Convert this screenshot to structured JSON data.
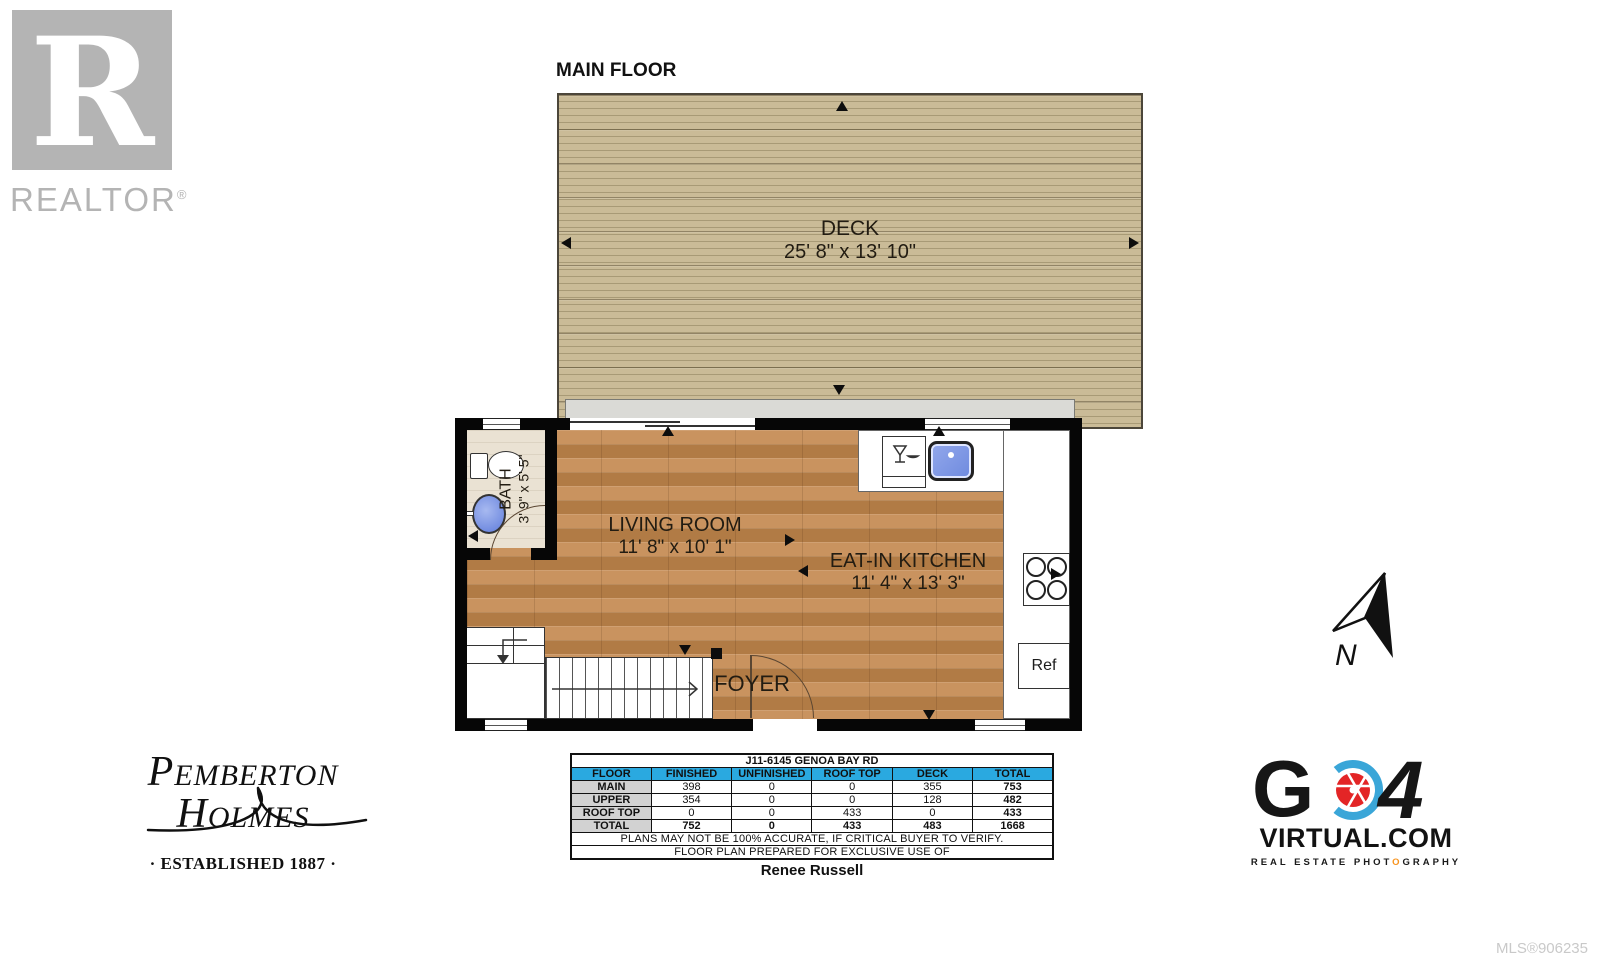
{
  "branding": {
    "realtor": {
      "letter": "R",
      "label": "REALTOR",
      "reg": "®"
    },
    "pemberton": {
      "cap1": "P",
      "rest1": "EMBERTON",
      "cap2": "H",
      "rest2": "OLMES",
      "established": "· ESTABLISHED 1887 ·"
    },
    "go4": {
      "g": "G",
      "four": "4",
      "virtual": "VIRTUAL.COM",
      "tagline_left": "REAL ESTATE PHOT",
      "tagline_o": "O",
      "tagline_right": "GRAPHY"
    },
    "mls": "MLS®906235"
  },
  "plan": {
    "title": "MAIN FLOOR",
    "north_letter": "N",
    "deck": {
      "name": "DECK",
      "dims": "25' 8\" x 13' 10\""
    },
    "living": {
      "name": "LIVING ROOM",
      "dims": "11' 8\" x 10' 1\""
    },
    "kitchen": {
      "name": "EAT-IN KITCHEN",
      "dims": "11' 4\" x 13' 3\""
    },
    "bath": {
      "name": "BATH",
      "dims": "3' 9\" x 5' 5\""
    },
    "foyer": {
      "name": "FOYER"
    },
    "fridge_label": "Ref"
  },
  "table": {
    "title": "J11-6145 GENOA BAY RD",
    "headers": [
      "FLOOR",
      "FINISHED",
      "UNFINISHED",
      "ROOF TOP",
      "DECK",
      "TOTAL"
    ],
    "rows": [
      {
        "cells": [
          "MAIN",
          "398",
          "0",
          "0",
          "355",
          "753"
        ]
      },
      {
        "cells": [
          "UPPER",
          "354",
          "0",
          "0",
          "128",
          "482"
        ]
      },
      {
        "cells": [
          "ROOF TOP",
          "0",
          "0",
          "433",
          "0",
          "433"
        ]
      },
      {
        "cells": [
          "TOTAL",
          "752",
          "0",
          "433",
          "483",
          "1668"
        ]
      }
    ],
    "disclaimer1": "PLANS MAY NOT BE 100% ACCURATE, IF CRITICAL BUYER TO VERIFY.",
    "disclaimer2": "FLOOR PLAN PREPARED FOR EXCLUSIVE USE OF",
    "prepared_for": "Renee Russell"
  },
  "colors": {
    "table_header_blue": "#2aa9e0",
    "wood_floor": "#c08955",
    "deck_wood": "#c3b491",
    "sink_blue": "#6e8ade",
    "logo_gray": "#b4b4b4",
    "tagline_orange": "#f7931e"
  }
}
